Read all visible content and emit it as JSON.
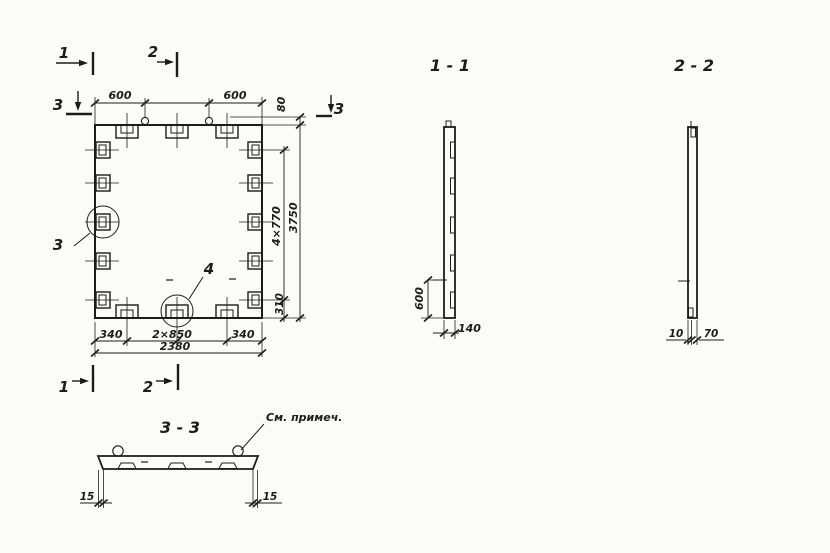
{
  "plan": {
    "marks": {
      "cut1_top": "1",
      "cut2_top": "2",
      "cut3_left": "3",
      "cut3_right": "3",
      "cut1_bottom": "1",
      "cut2_bottom": "2"
    },
    "details": {
      "left_circle": "3",
      "bottom_circle": "4"
    },
    "dims": {
      "top_left": "600",
      "top_right": "600",
      "lug_height": "80",
      "side_spacing": "4×770",
      "side_bottom": "310",
      "height_total": "3750",
      "bottom_left": "340",
      "bottom_middle": "2×850",
      "bottom_right": "340",
      "width_total": "2380"
    }
  },
  "section11": {
    "title": "1 - 1",
    "dim_height": "600",
    "dim_thickness": "140"
  },
  "section22": {
    "title": "2 - 2",
    "dim_left": "10",
    "dim_right": "70"
  },
  "section33": {
    "title": "3 - 3",
    "note": "См. примеч.",
    "dim_left": "15",
    "dim_right": "15"
  },
  "colors": {
    "ink": "#1c1c1c",
    "paper": "#fbfbf9"
  }
}
